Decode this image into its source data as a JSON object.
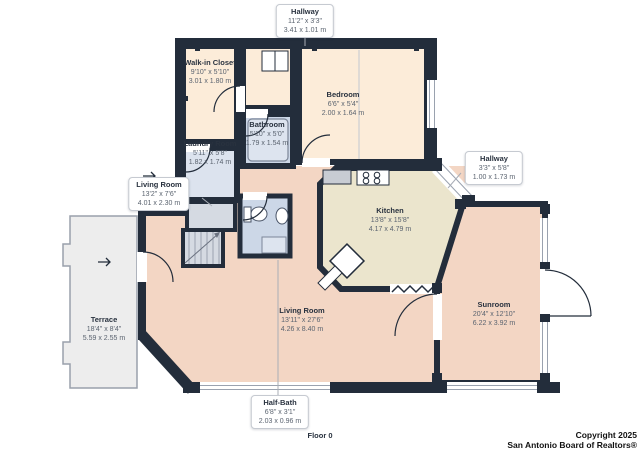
{
  "plan": {
    "floor_label": "Floor 0",
    "rooms": [
      {
        "id": "hallway-top",
        "name": "Hallway",
        "imperial": "11'2\" x 3'3\"",
        "metric": "3.41 x 1.01 m"
      },
      {
        "id": "walk-in-closet",
        "name": "Walk-in Closet",
        "imperial": "9'10\" x 5'10\"",
        "metric": "3.01 x 1.80 m"
      },
      {
        "id": "bedroom",
        "name": "Bedroom",
        "imperial": "6'6\" x 5'4\"",
        "metric": "2.00 x 1.64 m"
      },
      {
        "id": "bathroom",
        "name": "Bathroom",
        "imperial": "5'10\" x 5'0\"",
        "metric": "1.79 x 1.54 m"
      },
      {
        "id": "laundry-room",
        "name": "Laundry Room",
        "imperial": "5'11\" x 5'8\"",
        "metric": "1.82 x 1.74 m"
      },
      {
        "id": "living-room-small",
        "name": "Living Room",
        "imperial": "13'2\" x 7'6\"",
        "metric": "4.01 x 2.30 m"
      },
      {
        "id": "hallway-right",
        "name": "Hallway",
        "imperial": "3'3\" x 5'8\"",
        "metric": "1.00 x 1.73 m"
      },
      {
        "id": "kitchen",
        "name": "Kitchen",
        "imperial": "13'8\" x 15'8\"",
        "metric": "4.17 x 4.79 m"
      },
      {
        "id": "sunroom",
        "name": "Sunroom",
        "imperial": "20'4\" x 12'10\"",
        "metric": "6.22 x 3.92 m"
      },
      {
        "id": "terrace",
        "name": "Terrace",
        "imperial": "18'4\" x 8'4\"",
        "metric": "5.59 x 2.55 m"
      },
      {
        "id": "living-room-main",
        "name": "Living Room",
        "imperial": "13'11\" x 27'6\"",
        "metric": "4.26 x 8.40 m"
      },
      {
        "id": "half-bath",
        "name": "Half-Bath",
        "imperial": "6'8\" x 3'1\"",
        "metric": "2.03 x 0.96 m"
      }
    ],
    "colors": {
      "wall": "#232d3b",
      "room_cream": "#fcecd9",
      "room_pink": "#f3d6c4",
      "room_kitchen": "#ebe5cd",
      "room_bath_blue": "#ccd7e7",
      "room_laundry_blue": "#dce3ee",
      "stairs_gray": "#d5dae2",
      "terrace_gray": "#ededed"
    }
  },
  "footer": {
    "copyright_line1": "Copyright 2025",
    "copyright_line2": "San Antonio Board of Realtors®"
  }
}
